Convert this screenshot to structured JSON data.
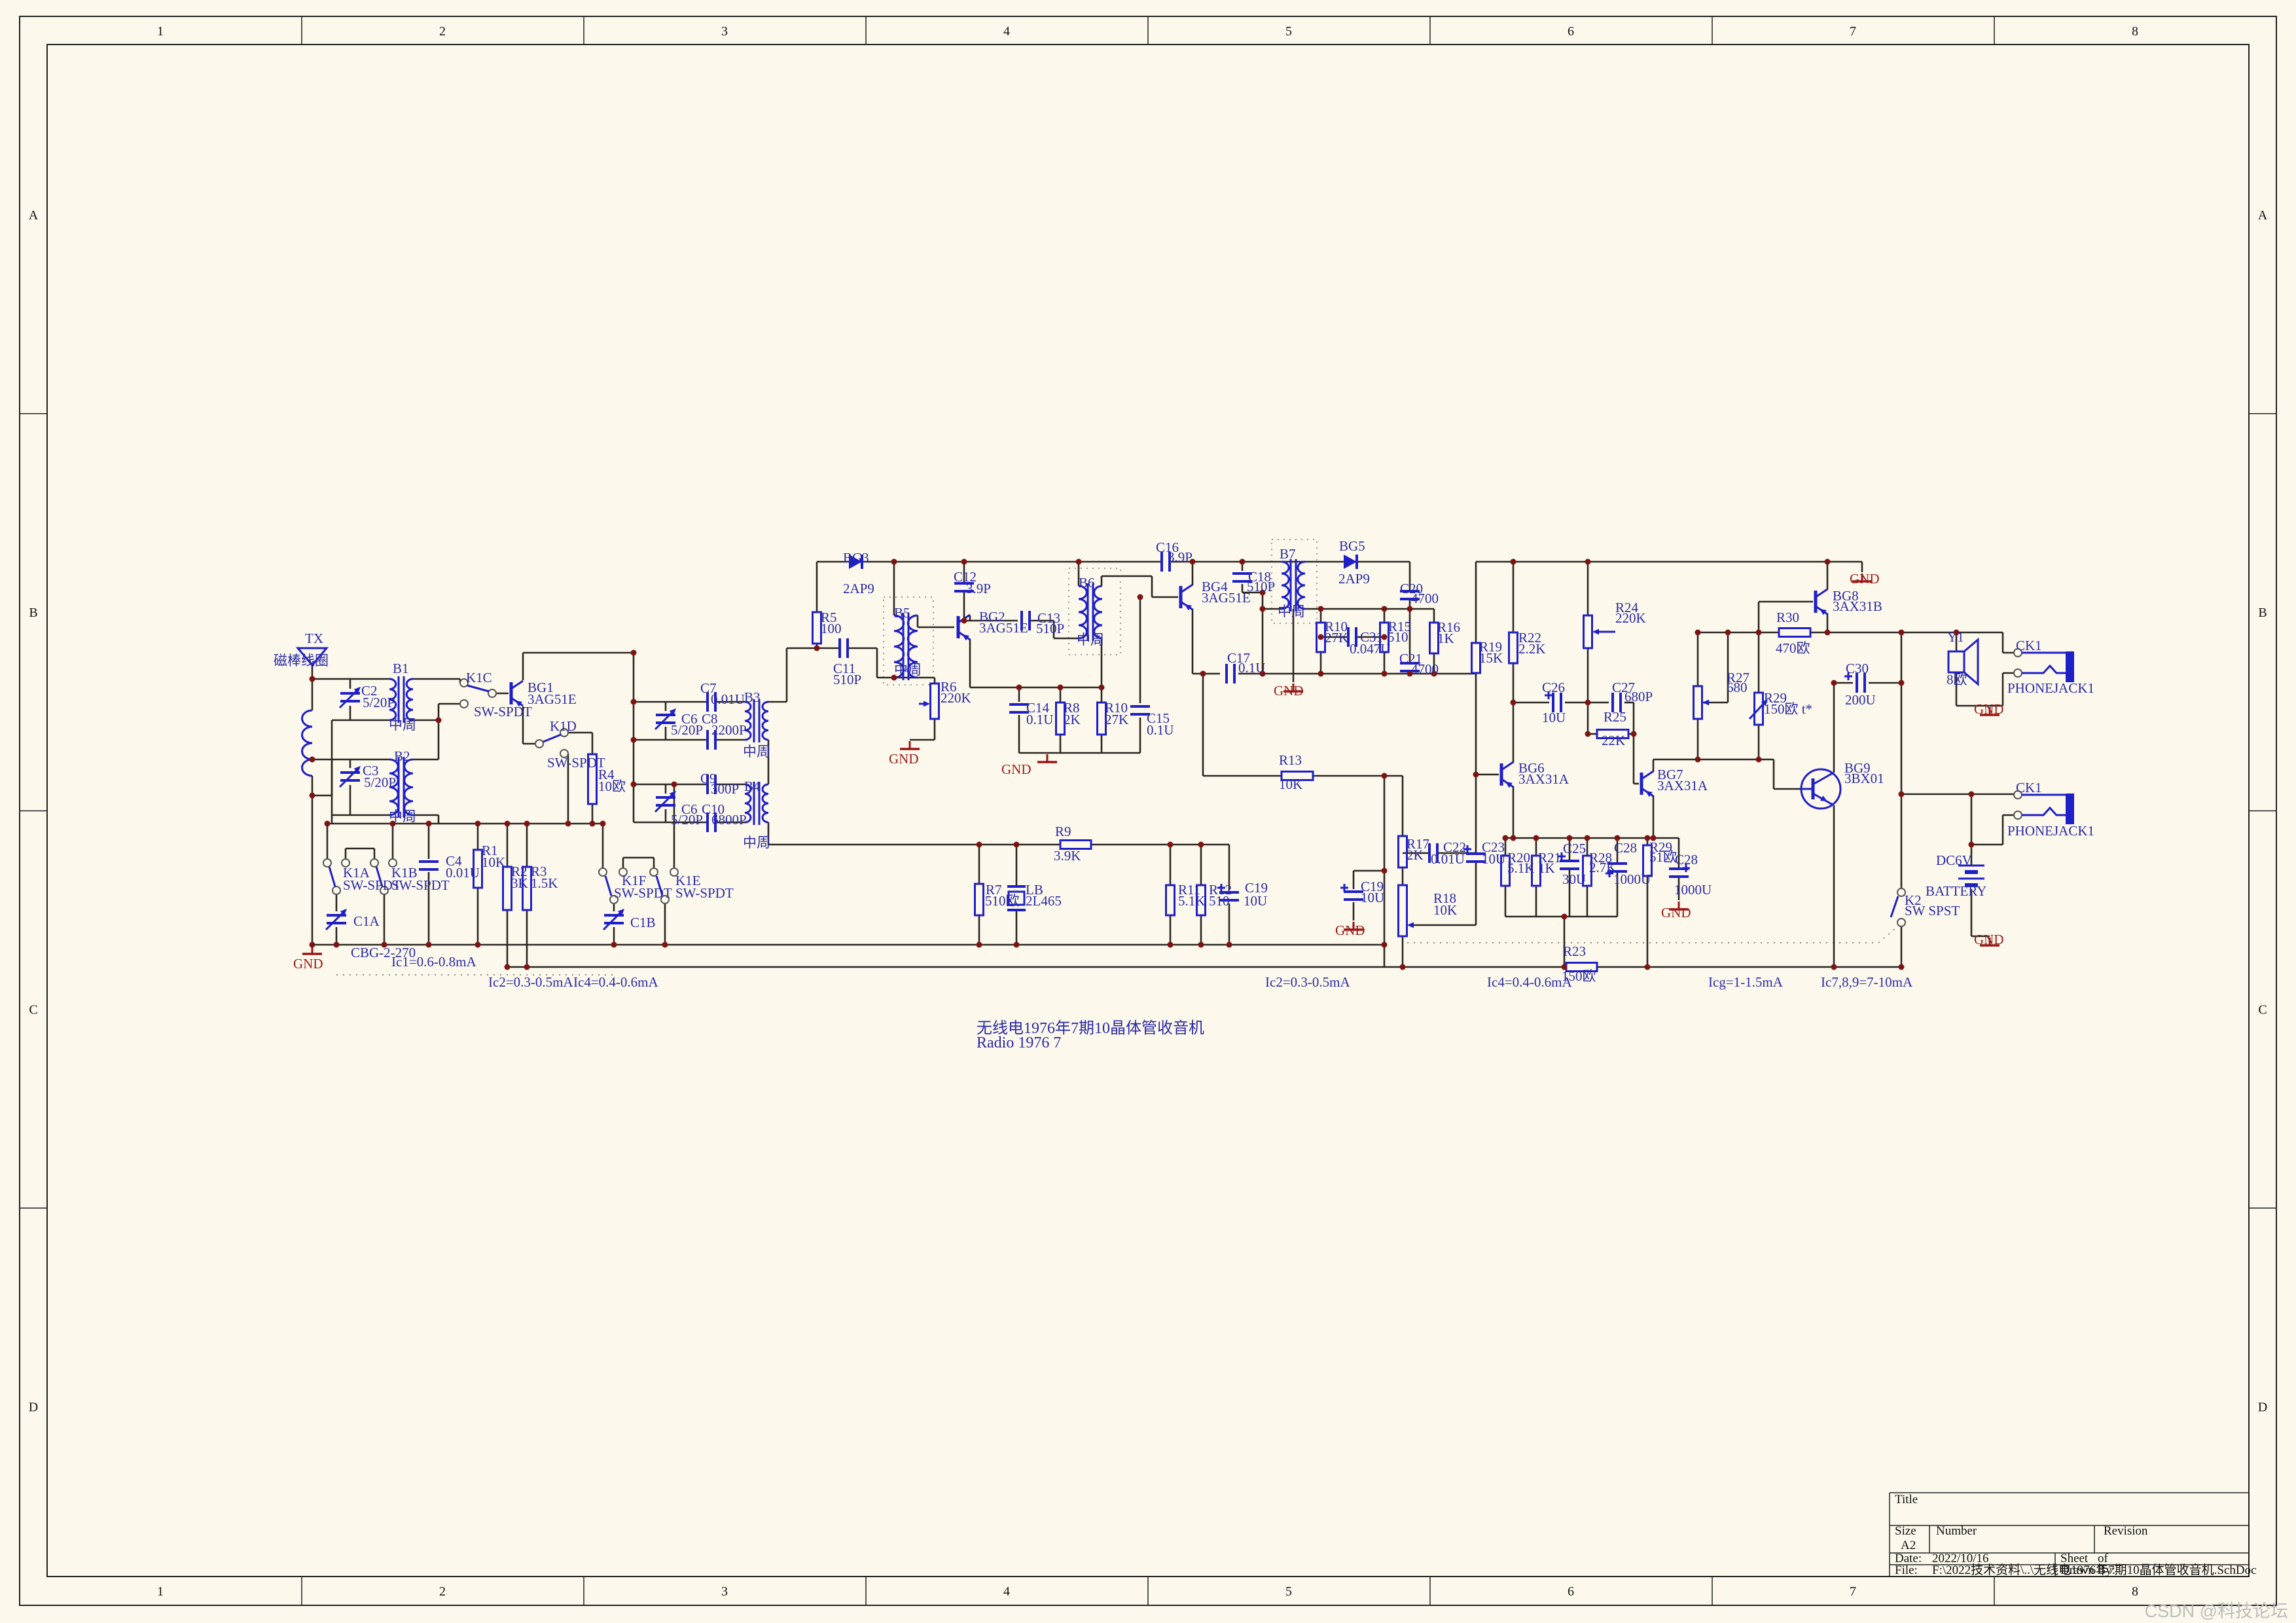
{
  "sheet": {
    "zones_h": [
      "1",
      "2",
      "3",
      "4",
      "5",
      "6",
      "7",
      "8"
    ],
    "zones_v": [
      "A",
      "B",
      "C",
      "D"
    ]
  },
  "caption": {
    "line1": "无线电1976年7期10晶体管收音机",
    "line2": "Radio 1976 7"
  },
  "watermark": "CSDN @科技论坛",
  "title_block": {
    "title_label": "Title",
    "size_label": "Size",
    "size": "A2",
    "number_label": "Number",
    "revision_label": "Revision",
    "date_label": "Date:",
    "date": "2022/10/16",
    "sheet_label": "Sheet",
    "of_label": "of",
    "file_label": "File:",
    "file": "F:\\2022技术资料\\..\\无线电1976年7期10晶体管收音机.SchDoc",
    "drawn_label": "Drawn By:"
  },
  "colors": {
    "component": "#1f1fc8",
    "label": "#2a2aa8",
    "wire": "#2b2723",
    "gnd": "#981616",
    "dot": "#7d1414",
    "background": "#fcf8eb"
  },
  "labels": [
    [
      "TX",
      466,
      982
    ],
    [
      "磁棒线圈",
      418,
      1016
    ],
    [
      "B1",
      600,
      1028
    ],
    [
      "中周",
      594,
      1114
    ],
    [
      "C2",
      552,
      1062
    ],
    [
      "5/20P",
      554,
      1080
    ],
    [
      "K1C",
      712,
      1042
    ],
    [
      "SW-SPDT",
      724,
      1094
    ],
    [
      "BG1",
      806,
      1057
    ],
    [
      "3AG51E",
      806,
      1075
    ],
    [
      "K1D",
      840,
      1116
    ],
    [
      "SW-SPDT",
      836,
      1172
    ],
    [
      "R4",
      914,
      1190
    ],
    [
      "10欧",
      914,
      1208
    ],
    [
      "B2",
      602,
      1162
    ],
    [
      "C3",
      554,
      1184
    ],
    [
      "5/20P",
      556,
      1202
    ],
    [
      "中周",
      594,
      1254
    ],
    [
      "K1A",
      524,
      1340
    ],
    [
      "SW-SPDT",
      524,
      1359
    ],
    [
      "K1B",
      598,
      1340
    ],
    [
      "SW-SPDT",
      598,
      1359
    ],
    [
      "C1A",
      540,
      1414
    ],
    [
      "CBG-2-270",
      536,
      1462
    ],
    [
      "GND",
      448,
      1479,
      "r"
    ],
    [
      "C4",
      681,
      1322
    ],
    [
      "0.01U",
      681,
      1340
    ],
    [
      "R1",
      736,
      1306
    ],
    [
      "10K",
      736,
      1324
    ],
    [
      "R2",
      781,
      1338
    ],
    [
      "3K",
      781,
      1356
    ],
    [
      "R3",
      811,
      1338
    ],
    [
      "1.5K",
      811,
      1356
    ],
    [
      "Ic1=0.6-0.8mA",
      598,
      1476
    ],
    [
      "Ic2=0.3-0.5mA",
      746,
      1507
    ],
    [
      "Ic4=0.4-0.6mA",
      876,
      1507
    ],
    [
      "K1F",
      950,
      1352
    ],
    [
      "SW-SPDT",
      938,
      1371
    ],
    [
      "K1E",
      1032,
      1352
    ],
    [
      "SW-SPDT",
      1032,
      1371
    ],
    [
      "C1B",
      963,
      1416
    ],
    [
      "C7",
      1070,
      1058
    ],
    [
      "0.01U",
      1086,
      1075
    ],
    [
      "C6",
      1041,
      1105
    ],
    [
      "5/20P",
      1025,
      1122
    ],
    [
      "C8",
      1072,
      1105
    ],
    [
      "2200P",
      1087,
      1122
    ],
    [
      "B3",
      1137,
      1072
    ],
    [
      "中周",
      1135,
      1155
    ],
    [
      "C9",
      1070,
      1196
    ],
    [
      "300P",
      1086,
      1212
    ],
    [
      "C6",
      1041,
      1243
    ],
    [
      "5/20P",
      1025,
      1259
    ],
    [
      "C10",
      1072,
      1243
    ],
    [
      "6800P",
      1087,
      1259
    ],
    [
      "B4",
      1137,
      1208
    ],
    [
      "中周",
      1135,
      1294
    ],
    [
      "BG3",
      1288,
      859
    ],
    [
      "2AP9",
      1288,
      906
    ],
    [
      "R5",
      1254,
      950
    ],
    [
      "100",
      1254,
      967
    ],
    [
      "C11",
      1273,
      1028
    ],
    [
      "510P",
      1273,
      1045
    ],
    [
      "B5",
      1366,
      943
    ],
    [
      "中周",
      1366,
      1030
    ],
    [
      "R6",
      1437,
      1056
    ],
    [
      "220K",
      1437,
      1073
    ],
    [
      "GND",
      1358,
      1166,
      "r"
    ],
    [
      "BG2",
      1496,
      949
    ],
    [
      "3AG51E",
      1496,
      966
    ],
    [
      "C12",
      1457,
      888
    ],
    [
      "3.9P",
      1476,
      906
    ],
    [
      "C13",
      1585,
      951
    ],
    [
      "510P",
      1583,
      967
    ],
    [
      "B6",
      1648,
      897
    ],
    [
      "中周",
      1645,
      984
    ],
    [
      "C14",
      1568,
      1088
    ],
    [
      "0.1U",
      1568,
      1106
    ],
    [
      "R8",
      1625,
      1088
    ],
    [
      "2K",
      1625,
      1106
    ],
    [
      "R10",
      1688,
      1088
    ],
    [
      "27K",
      1688,
      1106
    ],
    [
      "GND",
      1530,
      1182,
      "r"
    ],
    [
      "C15",
      1752,
      1104
    ],
    [
      "0.1U",
      1752,
      1122
    ],
    [
      "C16",
      1766,
      843
    ],
    [
      "3.9P",
      1784,
      858
    ],
    [
      "BG4",
      1836,
      903
    ],
    [
      "3AG51E",
      1836,
      920
    ],
    [
      "C18",
      1907,
      888
    ],
    [
      "510P",
      1905,
      903
    ],
    [
      "B7",
      1955,
      853
    ],
    [
      "中周",
      1952,
      941
    ],
    [
      "BG5",
      2046,
      841
    ],
    [
      "2AP9",
      2045,
      891
    ],
    [
      "C17",
      1875,
      1012
    ],
    [
      "0.1U",
      1892,
      1027
    ],
    [
      "GND",
      1946,
      1062,
      "r"
    ],
    [
      "R10",
      2024,
      964
    ],
    [
      "27K",
      2024,
      981
    ],
    [
      "C31",
      2078,
      980
    ],
    [
      "0.047U",
      2062,
      998
    ],
    [
      "R15",
      2121,
      964
    ],
    [
      "510",
      2120,
      980
    ],
    [
      "C20",
      2139,
      906
    ],
    [
      "4700",
      2156,
      921
    ],
    [
      "R16",
      2196,
      965
    ],
    [
      "1K",
      2196,
      982
    ],
    [
      "C21",
      2138,
      1013
    ],
    [
      "4700",
      2156,
      1029
    ],
    [
      "R13",
      1954,
      1168
    ],
    [
      "10K",
      1954,
      1205
    ],
    [
      "R9",
      1612,
      1277
    ],
    [
      "3.9K",
      1610,
      1314
    ],
    [
      "R7",
      1506,
      1366
    ],
    [
      "510欧",
      1505,
      1383
    ],
    [
      "LB",
      1567,
      1366
    ],
    [
      "2L465",
      1567,
      1383
    ],
    [
      "R11",
      1800,
      1366
    ],
    [
      "5.1K",
      1800,
      1383
    ],
    [
      "R12",
      1847,
      1366
    ],
    [
      "510",
      1847,
      1383
    ],
    [
      "C19",
      1902,
      1363
    ],
    [
      "10U",
      1900,
      1383
    ],
    [
      "Ic2=0.3-0.5mA",
      1933,
      1507
    ],
    [
      "Ic4=0.4-0.6mA",
      2272,
      1507
    ],
    [
      "R23",
      2388,
      1460
    ],
    [
      "150欧",
      2386,
      1498
    ],
    [
      "Icg=1-1.5mA",
      2610,
      1507
    ],
    [
      "Ic7,8,9=7-10mA",
      2782,
      1507
    ],
    [
      "C19",
      2079,
      1361
    ],
    [
      "10U",
      2079,
      1378
    ],
    [
      "GND",
      2040,
      1428,
      "r"
    ],
    [
      "R17",
      2149,
      1296
    ],
    [
      "2K",
      2149,
      1313
    ],
    [
      "C22",
      2205,
      1301
    ],
    [
      "0.01U",
      2186,
      1319
    ],
    [
      "C23",
      2264,
      1301
    ],
    [
      "10U",
      2264,
      1319
    ],
    [
      "R18",
      2190,
      1379
    ],
    [
      "10K",
      2190,
      1397
    ],
    [
      "R19",
      2260,
      995
    ],
    [
      "15K",
      2260,
      1012
    ],
    [
      "R22",
      2320,
      981
    ],
    [
      "2.2K",
      2320,
      998
    ],
    [
      "R24",
      2468,
      935
    ],
    [
      "220K",
      2468,
      951
    ],
    [
      "C26",
      2356,
      1057
    ],
    [
      "10U",
      2356,
      1103
    ],
    [
      "C27",
      2463,
      1057
    ],
    [
      "680P",
      2482,
      1071
    ],
    [
      "R25",
      2450,
      1102
    ],
    [
      "22K",
      2447,
      1138
    ],
    [
      "BG6",
      2320,
      1180
    ],
    [
      "3AX31A",
      2320,
      1197
    ],
    [
      "BG7",
      2532,
      1190
    ],
    [
      "3AX31A",
      2532,
      1207
    ],
    [
      "R20",
      2303,
      1317
    ],
    [
      "5.1K",
      2303,
      1333
    ],
    [
      "R21",
      2350,
      1317
    ],
    [
      "1K",
      2350,
      1333
    ],
    [
      "C25",
      2388,
      1303
    ],
    [
      "30U",
      2387,
      1350
    ],
    [
      "R28",
      2428,
      1317
    ],
    [
      "2.7K",
      2428,
      1332
    ],
    [
      "C28",
      2466,
      1302
    ],
    [
      "1000U",
      2465,
      1350
    ],
    [
      "R29",
      2520,
      1301
    ],
    [
      "51欧",
      2520,
      1316
    ],
    [
      "C28",
      2559,
      1320
    ],
    [
      "1000U",
      2558,
      1366
    ],
    [
      "GND",
      2538,
      1401,
      "r"
    ],
    [
      "R27",
      2638,
      1042
    ],
    [
      "680",
      2638,
      1057
    ],
    [
      "R29",
      2695,
      1073
    ],
    [
      "150欧  t*",
      2695,
      1090
    ],
    [
      "R30",
      2714,
      950
    ],
    [
      "470欧",
      2713,
      997
    ],
    [
      "BG8",
      2800,
      917
    ],
    [
      "3AX31B",
      2800,
      933
    ],
    [
      "GND",
      2826,
      891,
      "r"
    ],
    [
      "C30",
      2820,
      1028
    ],
    [
      "200U",
      2819,
      1076
    ],
    [
      "BG9",
      2818,
      1180
    ],
    [
      "3BX01",
      2818,
      1196
    ],
    [
      "Y1",
      2975,
      980
    ],
    [
      "8欧",
      2974,
      1045
    ],
    [
      "CK1",
      3080,
      993
    ],
    [
      "PHONEJACK1",
      3067,
      1058
    ],
    [
      "GND",
      3016,
      1090,
      "r"
    ],
    [
      "CK1",
      3080,
      1210
    ],
    [
      "PHONEJACK1",
      3067,
      1276
    ],
    [
      "DC6V",
      2958,
      1321
    ],
    [
      "BATTERY",
      2942,
      1368
    ],
    [
      "K2",
      2910,
      1382
    ],
    [
      "SW SPST",
      2910,
      1398
    ],
    [
      "GND",
      3016,
      1442,
      "r"
    ]
  ]
}
